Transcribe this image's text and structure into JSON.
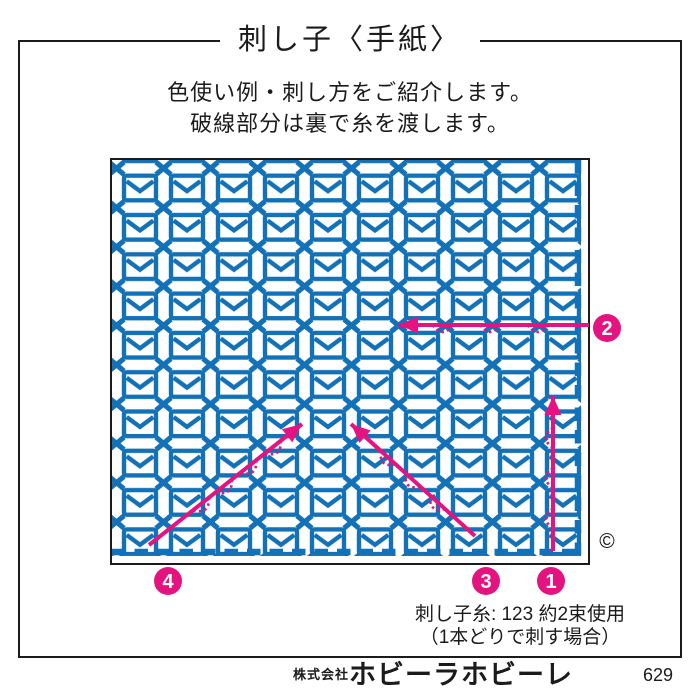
{
  "title": "刺し子〈手紙〉",
  "subtitle_lines": [
    "色使い例・刺し方をご紹介します。",
    "破線部分は裏で糸を渡します。"
  ],
  "pattern": {
    "motif": "envelope",
    "filler": "cross-stitch",
    "columns": 10,
    "rows": 10
  },
  "colors": {
    "stitch_blue": "#1371b8",
    "accent_magenta": "#e5137f",
    "ink": "#1b1b1b"
  },
  "annotations": {
    "copyright_symbol": "©",
    "steps": [
      {
        "num": "1",
        "badge": {
          "x": 551,
          "y": 581
        },
        "arrow": {
          "x1": 553,
          "y1": 551,
          "x2": 553,
          "y2": 396
        },
        "jump_side": 1,
        "jumps": [
          0.21,
          0.47,
          0.73
        ]
      },
      {
        "num": "2",
        "badge": {
          "x": 607,
          "y": 328
        },
        "arrow": {
          "x1": 589,
          "y1": 325,
          "x2": 399,
          "y2": 325
        },
        "jump_side": 1,
        "jumps": [
          0.27,
          0.52,
          0.77
        ]
      },
      {
        "num": "3",
        "badge": {
          "x": 486,
          "y": 581
        },
        "arrow": {
          "x1": 475,
          "y1": 536,
          "x2": 351,
          "y2": 424
        },
        "jump_side": 1,
        "jumps": [
          0.3,
          0.5,
          0.7
        ]
      },
      {
        "num": "4",
        "badge": {
          "x": 168,
          "y": 581
        },
        "arrow": {
          "x1": 149,
          "y1": 545,
          "x2": 302,
          "y2": 424
        },
        "jump_side": -1,
        "jumps": [
          0.34,
          0.49,
          0.65,
          0.81
        ]
      }
    ]
  },
  "notes": [
    "刺し子糸: 123 約2束使用",
    "（1本どりで刺す場合）"
  ],
  "footer": {
    "company_prefix": "株式会社",
    "brand": "ホビーラホビーレ",
    "page_number": "629"
  }
}
